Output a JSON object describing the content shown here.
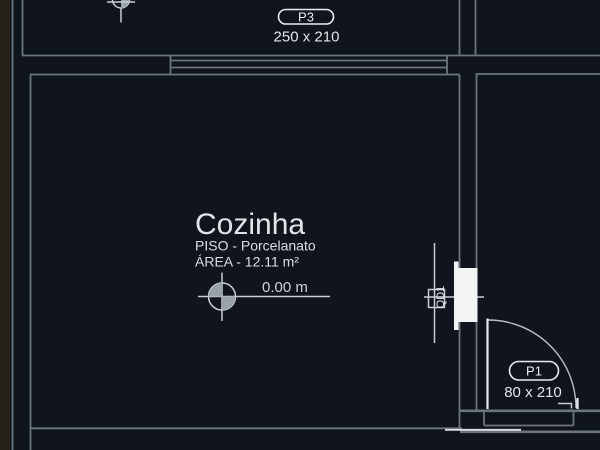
{
  "view": {
    "type": "cad-floor-plan",
    "background": "#10151d",
    "edge_strip_color": "#262119",
    "wall_line_color": "#6c7480",
    "highlight_color": "#e9ebee",
    "panel_fill": "#f2f3f4",
    "quadrant_fill": "#9aa1aa"
  },
  "room": {
    "name": "Cozinha",
    "floor": "PISO - Porcelanato",
    "area": "ÁREA - 12.11 m²",
    "level": "0.00 m"
  },
  "openings": {
    "p3": {
      "tag": "P3",
      "size": "250 x 210"
    },
    "p1": {
      "tag": "P1",
      "size": "80 x 210"
    }
  },
  "panel": {
    "tag": "QD1"
  }
}
